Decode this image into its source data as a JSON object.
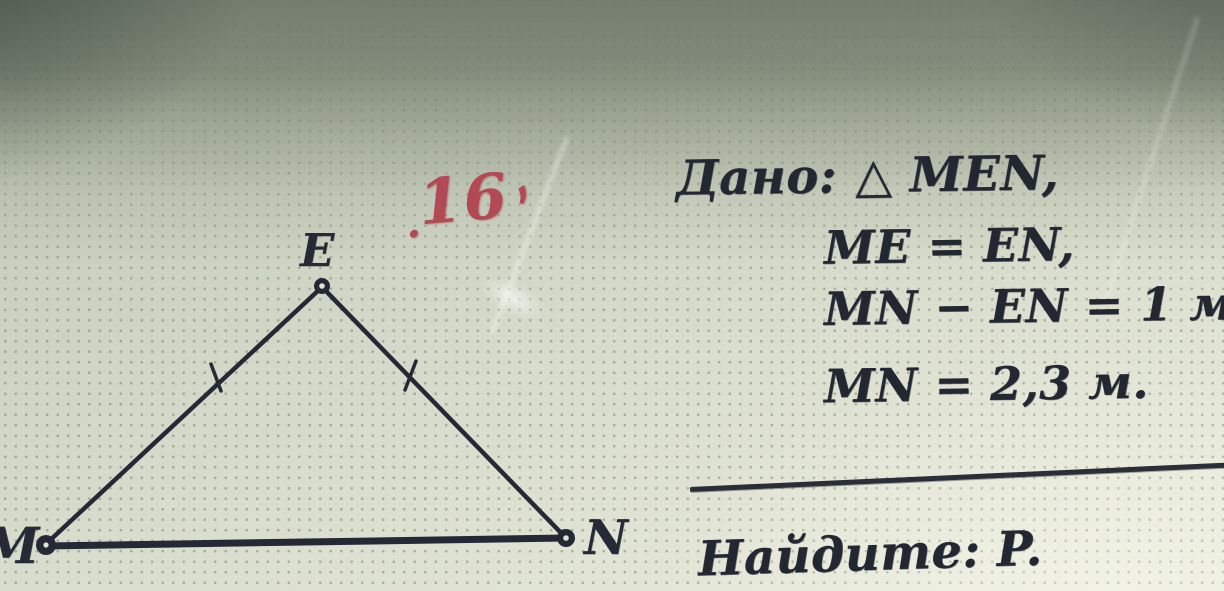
{
  "problem": {
    "number_annotation": {
      "mark_before": ".",
      "number": "16",
      "mark_after": ","
    },
    "given_label": "Дано:",
    "given_items": [
      "△ MEN,",
      "ME = EN,",
      "MN − EN = 1 м,",
      "MN = 2,3 м."
    ],
    "find_label": "Найдите:",
    "find_value": "P."
  },
  "figure": {
    "triangle_name": "MEN",
    "vertex_top": "E",
    "vertex_bottom_left": "M",
    "vertex_bottom_right": "N",
    "equal_sides": "ME = EN (tick marks)"
  },
  "colors": {
    "ink": "#252936",
    "red_annotation": "#b14a54",
    "paper_light": "#eaecdd",
    "paper_shadow_top": "#7d8677"
  }
}
